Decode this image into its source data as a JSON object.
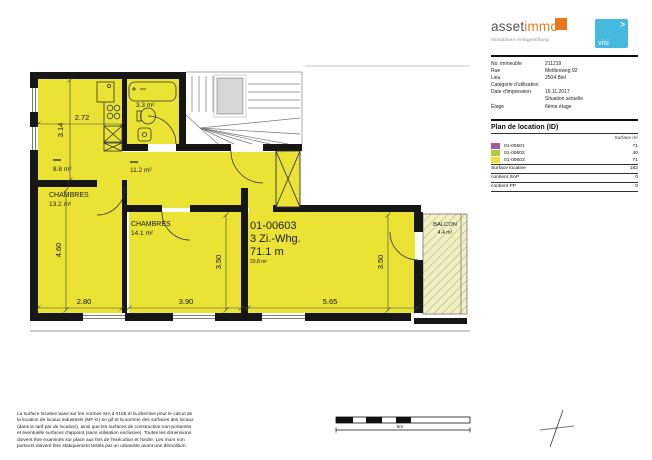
{
  "header": {
    "logo_part1": "asset",
    "logo_part2": "immo",
    "tagline": "Immobilien-Anlagestiftung",
    "badge_arrow": ">",
    "badge_text": "visi",
    "accent_orange": "#e8781e",
    "badge_blue": "#45b9de"
  },
  "details": {
    "rows": [
      {
        "label": "No. immeuble",
        "value": "211219"
      },
      {
        "label": "Rue",
        "value": "Mettlenweg 92"
      },
      {
        "label": "Lieu",
        "value": "2504   Biel"
      },
      {
        "label": "Catégorie d'utilisation",
        "value": ""
      },
      {
        "label": "Date d'impression",
        "value": "16.11.2017"
      },
      {
        "label": "",
        "value": "Situation actuelle"
      },
      {
        "label": "Étage",
        "value": "6ème étage"
      }
    ]
  },
  "legend": {
    "title": "Plan de location (ID)",
    "col_header": "Surface m²",
    "rows": [
      {
        "id": "01-00601",
        "surface": "71",
        "color": "#9d5ba1"
      },
      {
        "id": "01-00602",
        "surface": "40",
        "color": "#b3c938"
      },
      {
        "id": "01-00603",
        "surface": "71",
        "color": "#eae334"
      }
    ],
    "total_label": "Surface locative",
    "total_value": "182",
    "sap_label": "contient SAP",
    "sap_value": "0",
    "pp_label": "contient PP",
    "pp_value": "0"
  },
  "plan": {
    "unit": {
      "id": "01-00603",
      "type": "3 Zi.-Whg.",
      "area": "71.1 m",
      "living_area": "20.8 m²"
    },
    "rooms": {
      "kitchen_area": "8.8 m²",
      "hall_area": "11.2 m²",
      "bath_area": "3.3 m²",
      "bedroom1_name": "CHAMBRES",
      "bedroom1_area": "13.2 m²",
      "bedroom2_name": "CHAMBRES",
      "bedroom2_area": "14.1 m²",
      "balcony_name": "BALCON",
      "balcony_area": "4.4 m²"
    },
    "dims": {
      "kitchen_w": "2.72",
      "kitchen_h": "3.14",
      "bedroom1_h": "4.60",
      "bedroom1_w": "2.80",
      "bedroom2_w": "3.90",
      "bedroom2_h": "3.50",
      "living_w": "5.65",
      "living_h": "3.50"
    },
    "fill_yellow": "#eae334"
  },
  "scalebar": {
    "label": "5m"
  },
  "footer": {
    "lines": [
      "La surface locative base sur les normes SIA d 0165 et la directive pour le calcul de",
      "la location de locaux industriels (MF-G) en gif et la somme des surfaces des locaux",
      "(dans le tarif par de location), ainsi que les surfaces de construction non-portantes",
      "et éventuelle surfaces d'appoint (sans utilisation exclusive). Toutes les dimensions",
      "doivent être examinés sur place aux fins de l'exécution et l'ordre. Les murs non",
      "porteurs doivent être statiquement testés par un urbaniste avant une démolition."
    ]
  }
}
